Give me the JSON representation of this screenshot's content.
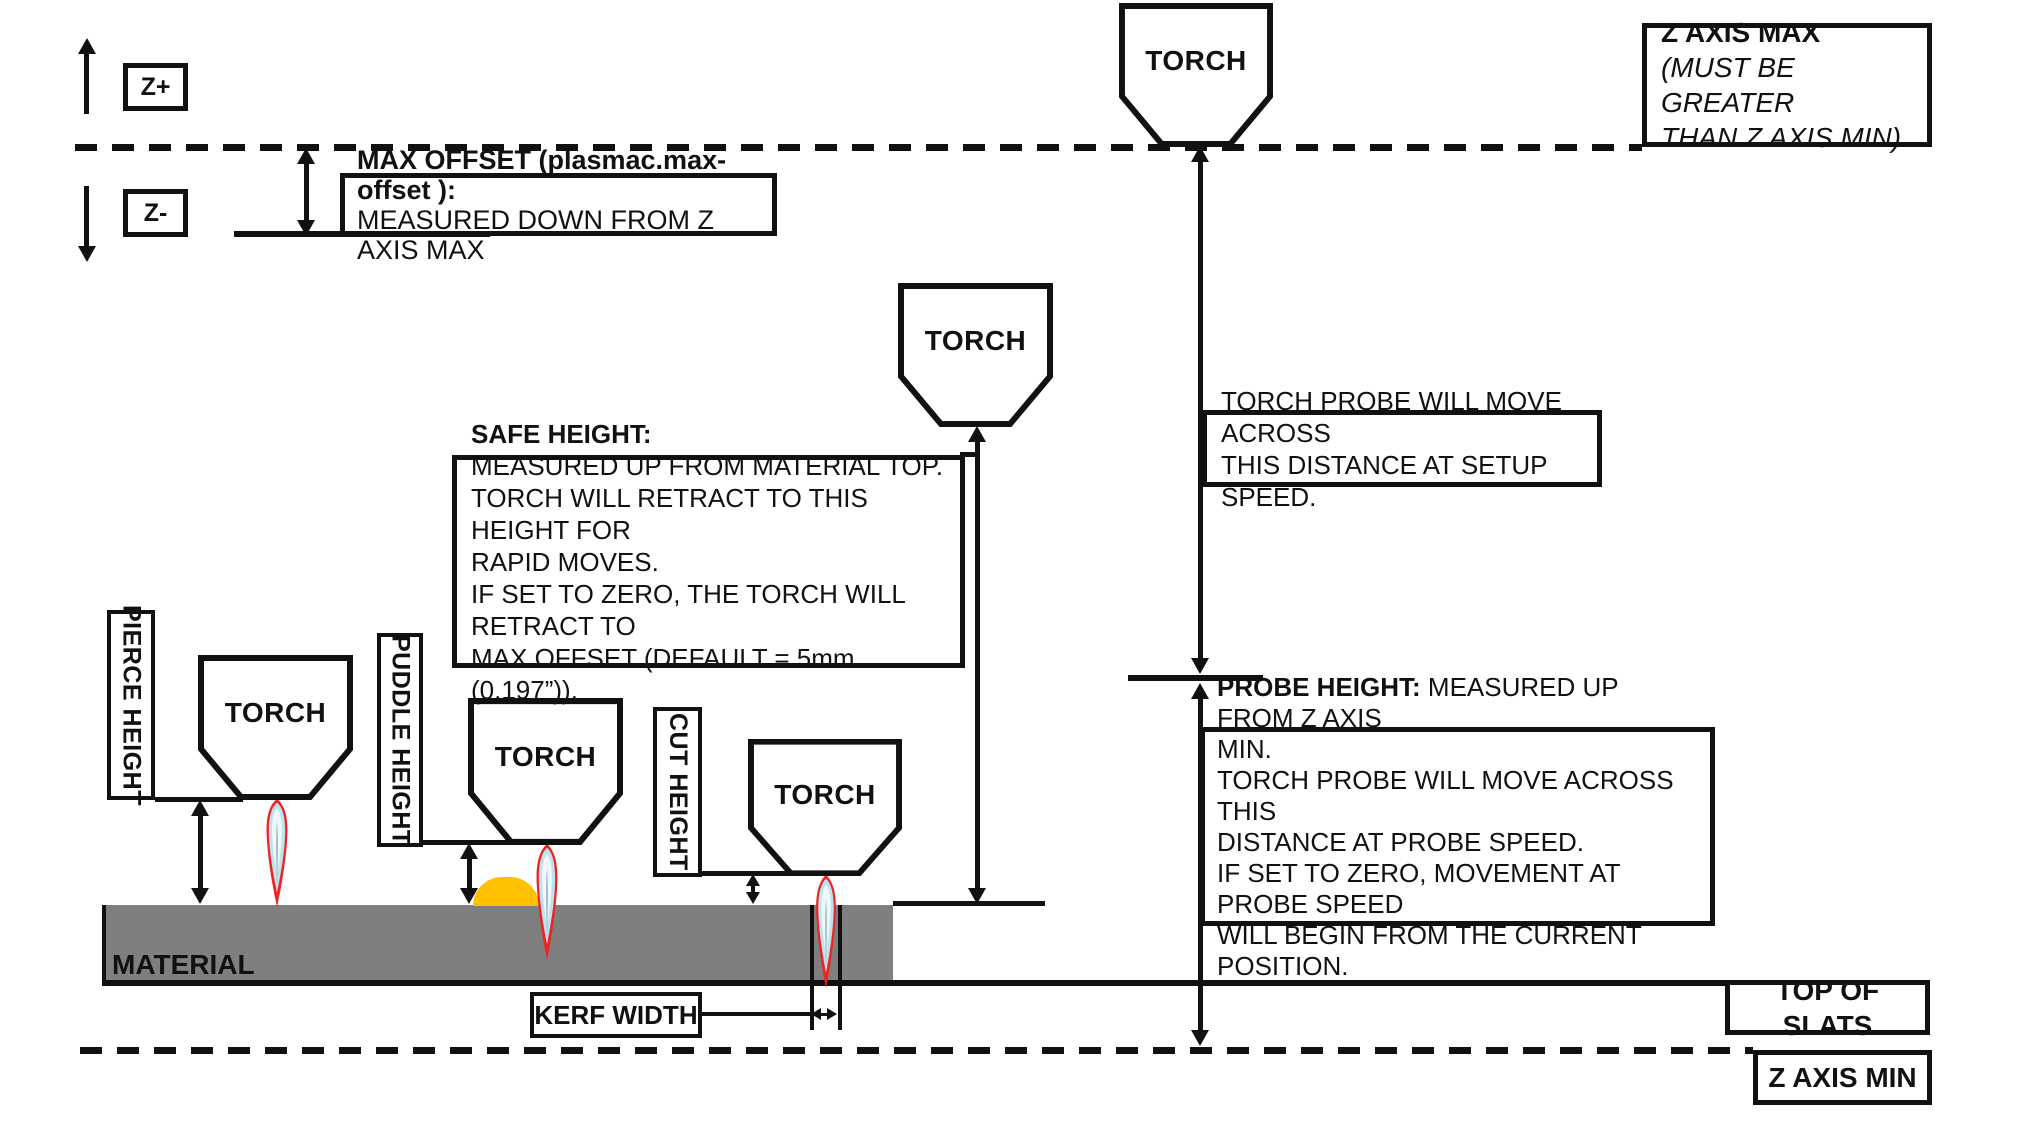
{
  "axis": {
    "z_plus": "Z+",
    "z_minus": "Z-"
  },
  "torch_label": "TORCH",
  "max_offset": {
    "line1": "MAX OFFSET (plasmac.max-offset ):",
    "line2": "MEASURED DOWN FROM Z AXIS MAX"
  },
  "z_axis_max": {
    "title": "Z AXIS MAX",
    "note1": "(MUST BE GREATER",
    "note2": "THAN Z AXIS MIN)"
  },
  "safe_height": {
    "title": "SAFE HEIGHT:",
    "lines": [
      "MEASURED UP FROM MATERIAL TOP.",
      "TORCH WILL RETRACT TO THIS HEIGHT FOR",
      "RAPID MOVES.",
      "IF SET TO ZERO, THE TORCH WILL RETRACT TO",
      "MAX OFFSET (DEFAULT = 5mm (0.197”))."
    ]
  },
  "torch_probe": {
    "line1": "TORCH PROBE WILL MOVE ACROSS",
    "line2": "THIS DISTANCE AT SETUP SPEED."
  },
  "probe_height": {
    "title": "PROBE HEIGHT:",
    "title_rest": " MEASURED UP FROM Z AXIS",
    "lines": [
      "MIN.",
      "TORCH PROBE WILL MOVE ACROSS THIS",
      "DISTANCE AT PROBE SPEED.",
      "IF SET TO ZERO,  MOVEMENT AT PROBE SPEED",
      "WILL BEGIN FROM THE CURRENT POSITION."
    ]
  },
  "labels": {
    "pierce_height": "PIERCE HEIGHT",
    "puddle_height": "PUDDLE HEIGHT",
    "cut_height": "CUT HEIGHT",
    "kerf_width": "KERF WIDTH",
    "material": "MATERIAL",
    "top_of_slats": "TOP OF SLATS",
    "z_axis_min": "Z AXIS MIN"
  },
  "colors": {
    "line_black": "#111111",
    "material_gray": "#7f7f7f",
    "puddle_orange": "#ffc000",
    "flame_red": "#ee2424",
    "flame_blue": "#bfe3ee",
    "flame_core": "#eef8fb",
    "flame_sliver": "#9fb6bd"
  }
}
